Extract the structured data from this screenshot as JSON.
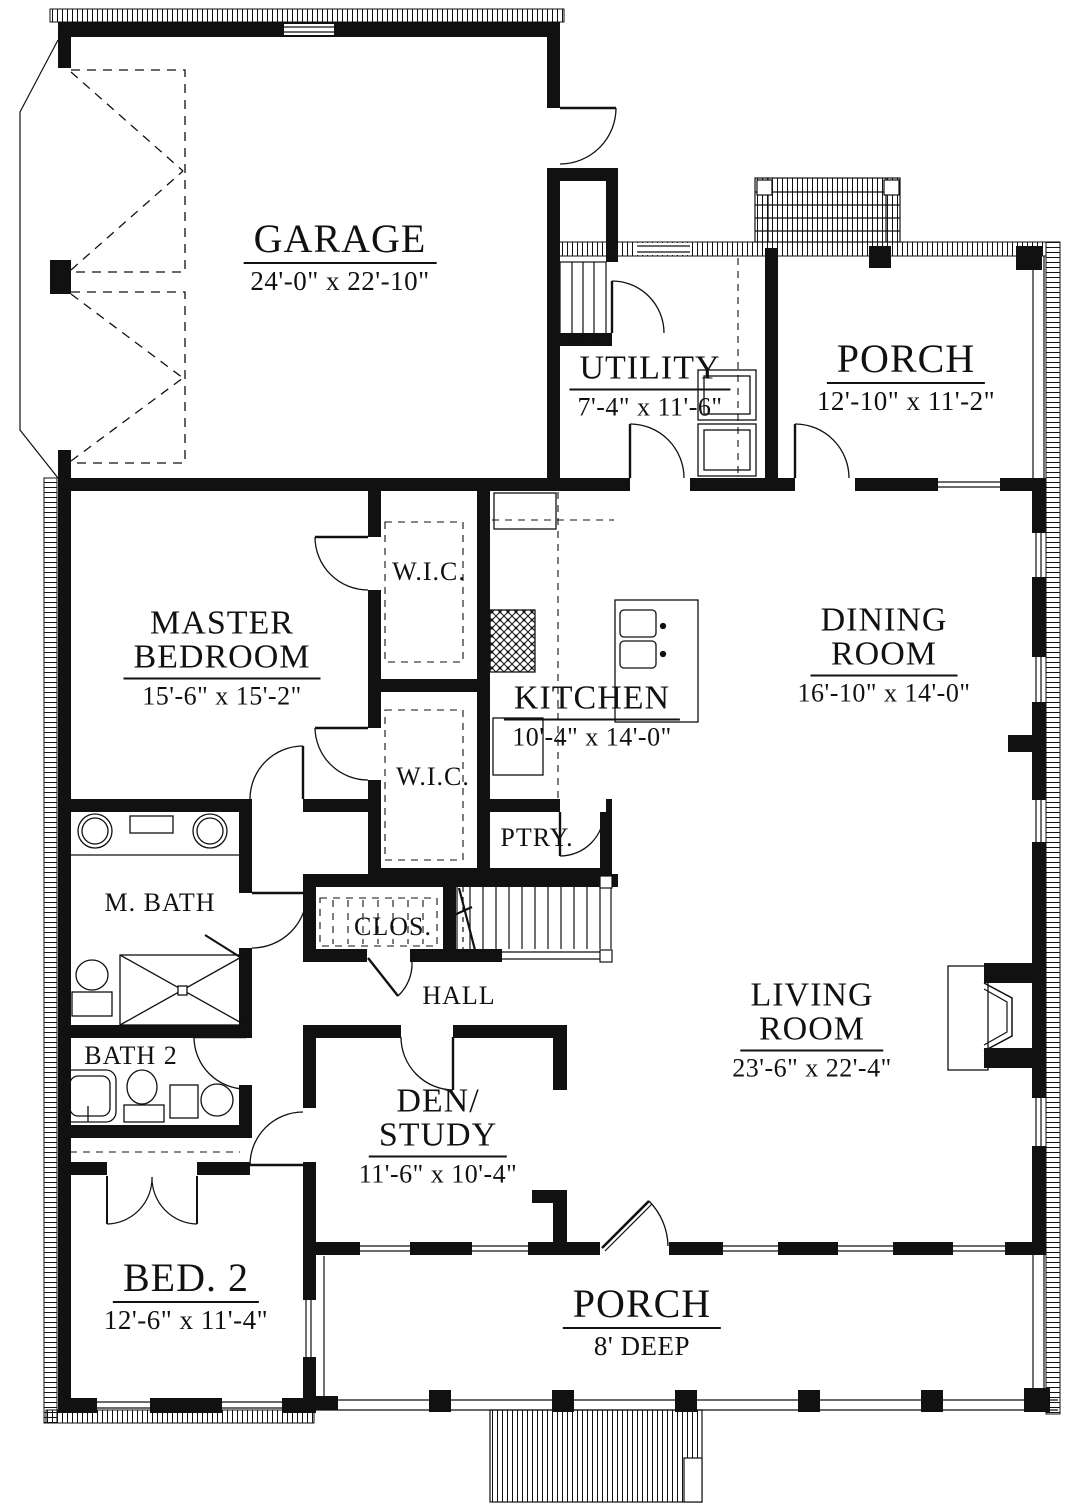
{
  "rooms": {
    "garage": {
      "lines": [
        "GARAGE"
      ],
      "dims": "24'-0\" x 22'-10\""
    },
    "utility": {
      "lines": [
        "UTILITY"
      ],
      "dims": "7'-4\" x 11'-6\""
    },
    "porch_upper": {
      "lines": [
        "PORCH"
      ],
      "dims": "12'-10\" x 11'-2\""
    },
    "master_bedroom": {
      "lines": [
        "MASTER",
        "BEDROOM"
      ],
      "dims": "15'-6\" x 15'-2\""
    },
    "wic_upper": {
      "lines": [
        "W.I.C."
      ]
    },
    "wic_lower": {
      "lines": [
        "W.I.C."
      ]
    },
    "kitchen": {
      "lines": [
        "KITCHEN"
      ],
      "dims": "10'-4\" x 14'-0\""
    },
    "dining": {
      "lines": [
        "DINING",
        "ROOM"
      ],
      "dims": "16'-10\" x 14'-0\""
    },
    "pantry": {
      "lines": [
        "PTRY."
      ]
    },
    "master_bath": {
      "lines": [
        "M. BATH"
      ]
    },
    "closet": {
      "lines": [
        "CLOS."
      ]
    },
    "hall": {
      "lines": [
        "HALL"
      ]
    },
    "living": {
      "lines": [
        "LIVING",
        "ROOM"
      ],
      "dims": "23'-6\" x 22'-4\""
    },
    "bath2": {
      "lines": [
        "BATH 2"
      ]
    },
    "den": {
      "lines": [
        "DEN/",
        "STUDY"
      ],
      "dims": "11'-6\" x 10'-4\""
    },
    "bed2": {
      "lines": [
        "BED. 2"
      ],
      "dims": "12'-6\" x 11'-4\""
    },
    "porch_lower": {
      "lines": [
        "PORCH"
      ],
      "dims": "8' DEEP"
    }
  },
  "colors": {
    "line": "#111111",
    "background": "#ffffff"
  }
}
